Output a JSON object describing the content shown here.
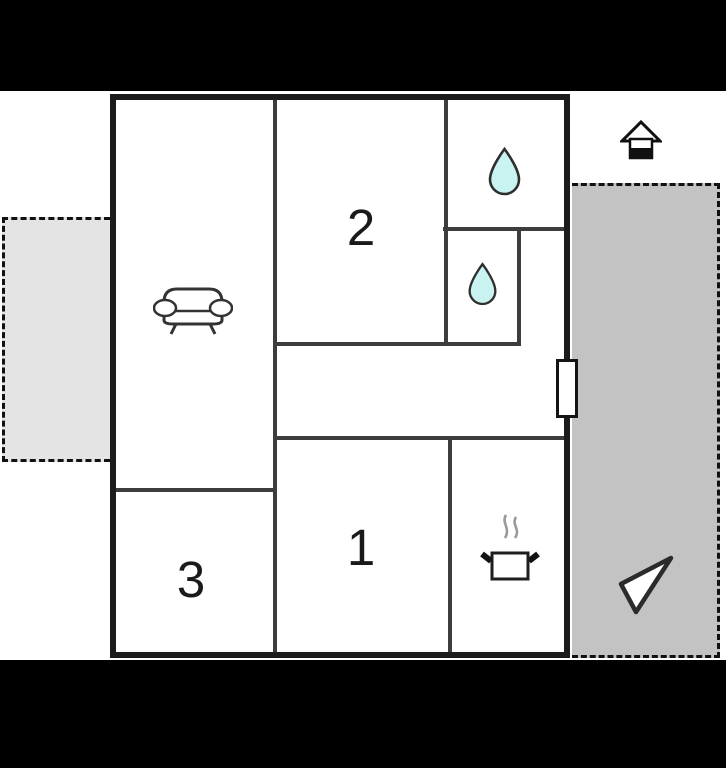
{
  "scene": {
    "type": "apartment-floor-plan",
    "letterbox_color": "#000000",
    "canvas_color": "#ffffff"
  },
  "rooms": [
    {
      "id": "room-2",
      "number": "2"
    },
    {
      "id": "room-1",
      "number": "1"
    },
    {
      "id": "room-3",
      "number": "3"
    }
  ],
  "icons": {
    "sofa": "sofa-icon (living room)",
    "water_drop_top": "water-drop-icon (bathroom)",
    "water_drop_middle": "water-drop-icon (bathroom)",
    "cooking_pot": "cooking-pot-icon (kitchen)",
    "house": "house-icon (floor indicator)",
    "north_arrow": "north-arrow-icon (orientation)",
    "door": "door-marker (entrance on right wall)"
  },
  "colors": {
    "outer_wall": "#1c1c1c",
    "interior_wall": "#3d3d3d",
    "water_drop_fill": "#c9f3f0",
    "terrace_left_fill": "#e4e4e4",
    "terrace_right_fill": "#c3c3c3",
    "dashed_border": "#111111"
  }
}
